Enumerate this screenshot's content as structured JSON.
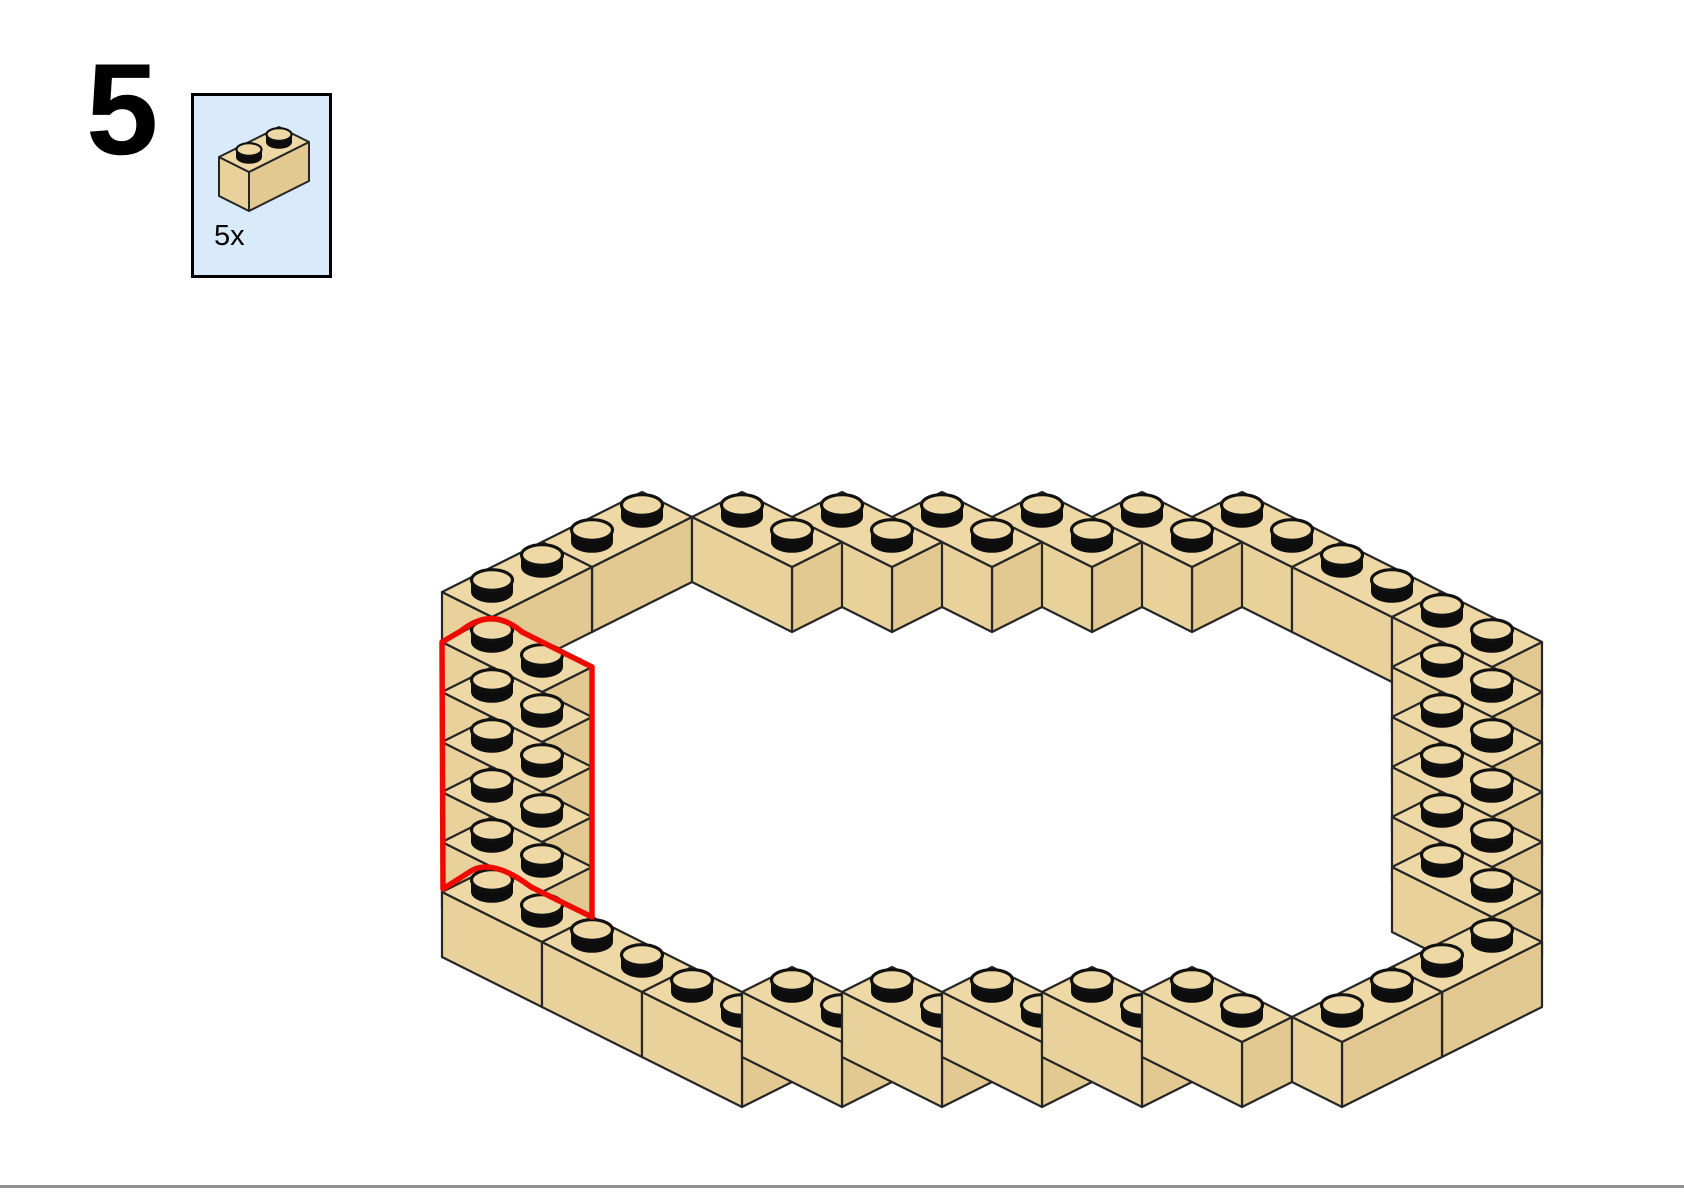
{
  "page": {
    "background": "#ffffff"
  },
  "step": {
    "number": "5"
  },
  "parts_callout": {
    "count_label": "5x",
    "background": "#d9ebfa",
    "border_color": "#000000",
    "part": {
      "name": "brick-1x2-tan",
      "axis": "j",
      "cells": [
        [
          0,
          0
        ],
        [
          0,
          1
        ]
      ]
    }
  },
  "colors": {
    "brick_top": "#eed9a6",
    "brick_left": "#e9d19c",
    "brick_right": "#e2c891",
    "outline": "#262626",
    "stud_side": "#0d0d0d",
    "highlight": "#ee0a00",
    "footer_rule": "#8f8f8f"
  },
  "assembly": {
    "description": "isometric oval ring of 30 tan 1x2 bricks, one brick tall; the 5 new bricks of this step form the left staircase and are outlined in red",
    "new_part_count": 5,
    "bricks": [
      {
        "id": "TL2",
        "cells": [
          [
            -1,
            -4
          ],
          [
            -1,
            -3
          ]
        ],
        "axis": "j",
        "new": false
      },
      {
        "id": "TL1",
        "cells": [
          [
            -1,
            -2
          ],
          [
            -1,
            -1
          ]
        ],
        "axis": "j",
        "new": false
      },
      {
        "id": "R1",
        "cells": [
          [
            0,
            0
          ],
          [
            1,
            0
          ]
        ],
        "axis": "i",
        "new": true
      },
      {
        "id": "R2",
        "cells": [
          [
            1,
            1
          ],
          [
            2,
            1
          ]
        ],
        "axis": "i",
        "new": true
      },
      {
        "id": "R3",
        "cells": [
          [
            2,
            2
          ],
          [
            3,
            2
          ]
        ],
        "axis": "i",
        "new": true
      },
      {
        "id": "R4",
        "cells": [
          [
            3,
            3
          ],
          [
            4,
            3
          ]
        ],
        "axis": "i",
        "new": true
      },
      {
        "id": "R5",
        "cells": [
          [
            4,
            4
          ],
          [
            5,
            4
          ]
        ],
        "axis": "i",
        "new": true
      },
      {
        "id": "BL1",
        "cells": [
          [
            5,
            5
          ],
          [
            6,
            5
          ]
        ],
        "axis": "i",
        "new": false
      },
      {
        "id": "BL2",
        "cells": [
          [
            7,
            5
          ],
          [
            8,
            5
          ]
        ],
        "axis": "i",
        "new": false
      },
      {
        "id": "B1",
        "cells": [
          [
            9,
            5
          ],
          [
            10,
            5
          ]
        ],
        "axis": "i",
        "new": false
      },
      {
        "id": "B2",
        "cells": [
          [
            10,
            4
          ],
          [
            11,
            4
          ]
        ],
        "axis": "i",
        "new": false
      },
      {
        "id": "B3",
        "cells": [
          [
            11,
            3
          ],
          [
            12,
            3
          ]
        ],
        "axis": "i",
        "new": false
      },
      {
        "id": "B4",
        "cells": [
          [
            12,
            2
          ],
          [
            13,
            2
          ]
        ],
        "axis": "i",
        "new": false
      },
      {
        "id": "B5",
        "cells": [
          [
            13,
            1
          ],
          [
            14,
            1
          ]
        ],
        "axis": "i",
        "new": false
      },
      {
        "id": "B6",
        "cells": [
          [
            14,
            0
          ],
          [
            15,
            0
          ]
        ],
        "axis": "i",
        "new": false
      },
      {
        "id": "BR1",
        "cells": [
          [
            16,
            -2
          ],
          [
            16,
            -1
          ]
        ],
        "axis": "j",
        "new": false
      },
      {
        "id": "BR2",
        "cells": [
          [
            16,
            -4
          ],
          [
            16,
            -3
          ]
        ],
        "axis": "j",
        "new": false
      },
      {
        "id": "RS6",
        "cells": [
          [
            14,
            -5
          ],
          [
            15,
            -5
          ]
        ],
        "axis": "i",
        "new": false
      },
      {
        "id": "RS5",
        "cells": [
          [
            13,
            -6
          ],
          [
            14,
            -6
          ]
        ],
        "axis": "i",
        "new": false
      },
      {
        "id": "RS4",
        "cells": [
          [
            12,
            -7
          ],
          [
            13,
            -7
          ]
        ],
        "axis": "i",
        "new": false
      },
      {
        "id": "RS3",
        "cells": [
          [
            11,
            -8
          ],
          [
            12,
            -8
          ]
        ],
        "axis": "i",
        "new": false
      },
      {
        "id": "RS2",
        "cells": [
          [
            10,
            -9
          ],
          [
            11,
            -9
          ]
        ],
        "axis": "i",
        "new": false
      },
      {
        "id": "RS1",
        "cells": [
          [
            9,
            -10
          ],
          [
            10,
            -10
          ]
        ],
        "axis": "i",
        "new": false
      },
      {
        "id": "TR2",
        "cells": [
          [
            7,
            -10
          ],
          [
            8,
            -10
          ]
        ],
        "axis": "i",
        "new": false
      },
      {
        "id": "TR1",
        "cells": [
          [
            5,
            -10
          ],
          [
            6,
            -10
          ]
        ],
        "axis": "i",
        "new": false
      },
      {
        "id": "T5",
        "cells": [
          [
            4,
            -9
          ],
          [
            5,
            -9
          ]
        ],
        "axis": "i",
        "new": false
      },
      {
        "id": "T4",
        "cells": [
          [
            3,
            -8
          ],
          [
            4,
            -8
          ]
        ],
        "axis": "i",
        "new": false
      },
      {
        "id": "T3",
        "cells": [
          [
            2,
            -7
          ],
          [
            3,
            -7
          ]
        ],
        "axis": "i",
        "new": false
      },
      {
        "id": "T2",
        "cells": [
          [
            1,
            -6
          ],
          [
            2,
            -6
          ]
        ],
        "axis": "i",
        "new": false
      },
      {
        "id": "T1",
        "cells": [
          [
            0,
            -5
          ],
          [
            1,
            -5
          ]
        ],
        "axis": "i",
        "new": false
      }
    ],
    "highlight_path": "M 442,642 L 461,631 Q 492,606 522,632 L 592,667 L 592,917 L 531,887 Q 490,856 468,873 L 443,889 Z"
  }
}
